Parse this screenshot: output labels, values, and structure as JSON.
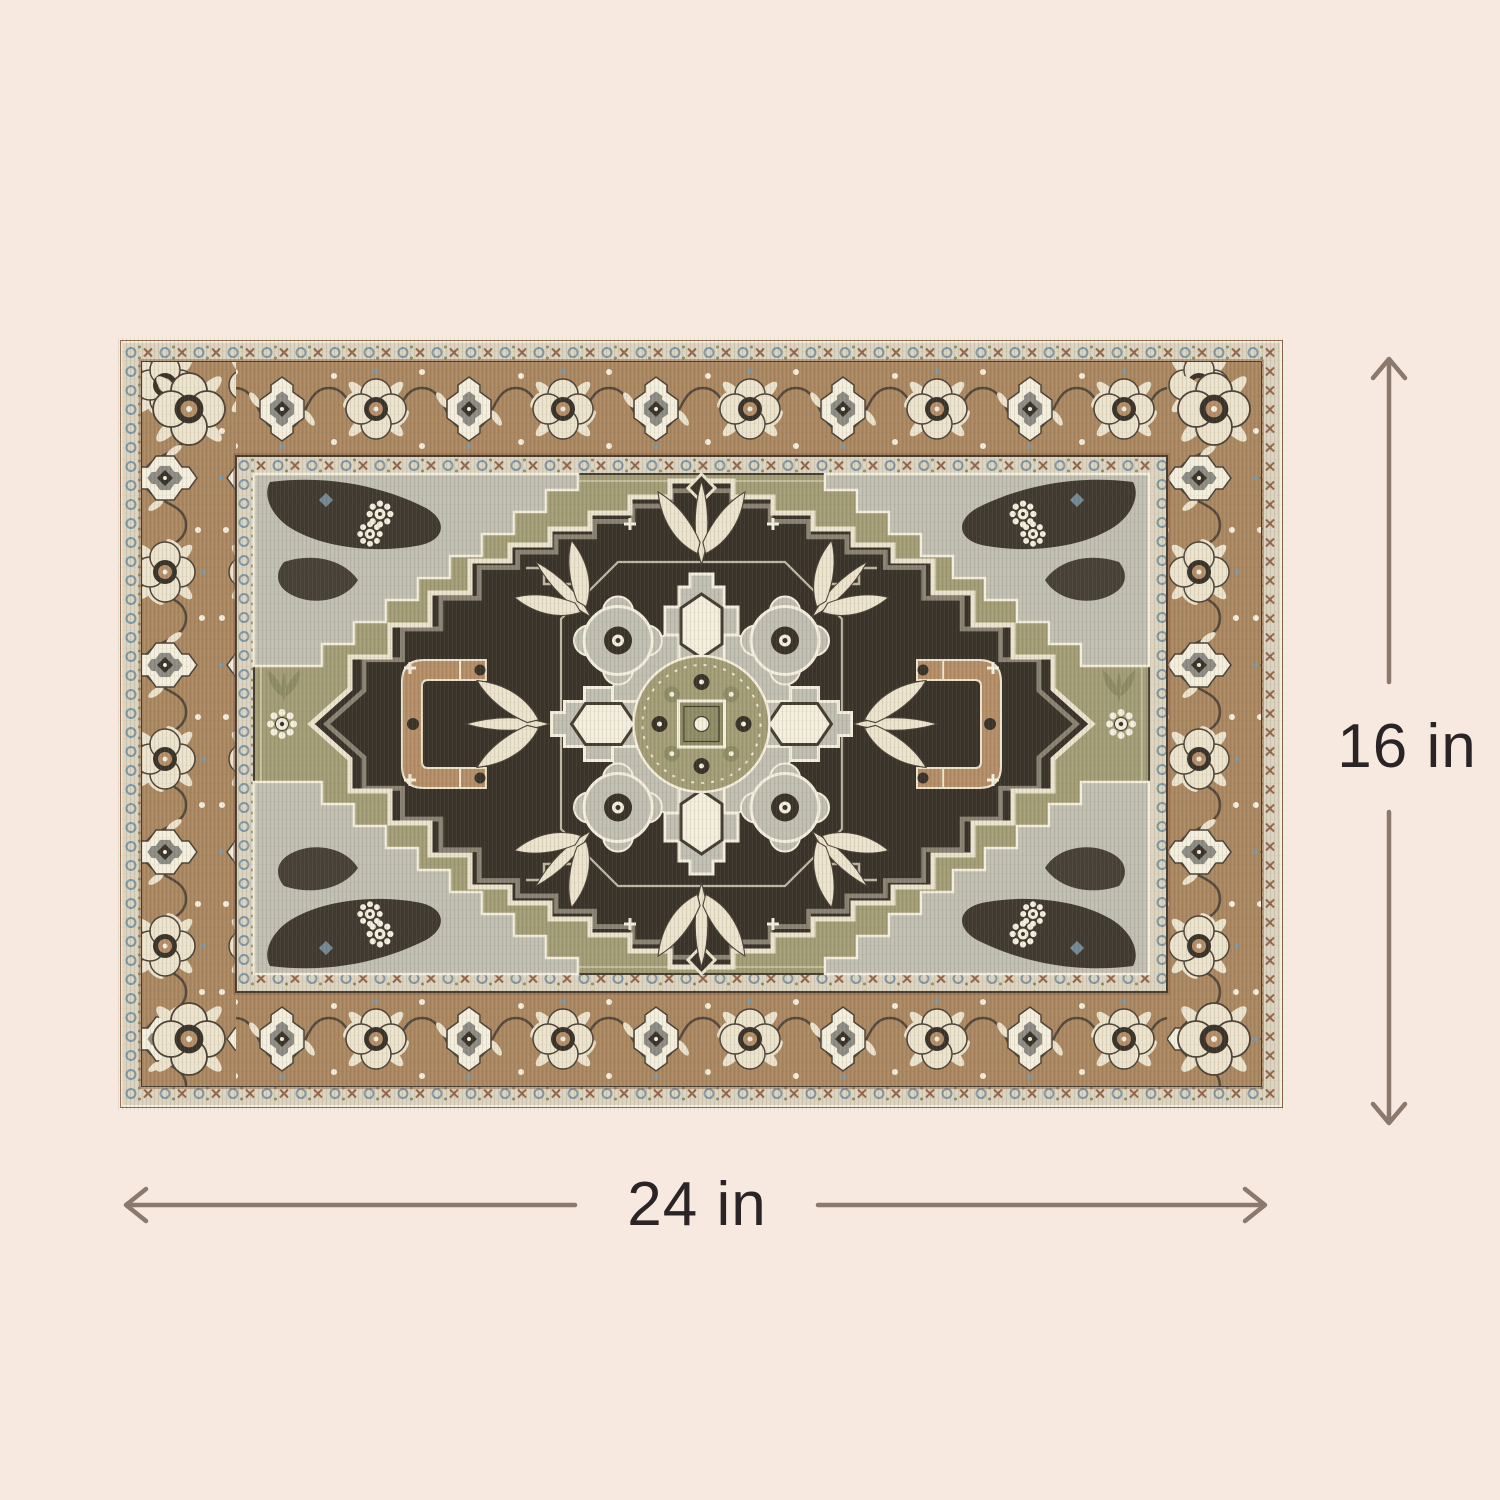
{
  "image": {
    "description": "Product dimension illustration of an ornate oriental medallion area rug on a plain cream background",
    "background_color": "#f8e9e0"
  },
  "dimensions": {
    "width": {
      "label": "24 in"
    },
    "height": {
      "label": "16 in"
    }
  },
  "annotation": {
    "arrow_color": "#8a796c",
    "label_color": "#2b2426"
  },
  "rug": {
    "style": "heriz-medallion-rug",
    "palette": {
      "brown": "#ab8861",
      "cream": "#ece3cd",
      "cream2": "#f4eede",
      "charcoal": "#3a332a",
      "olive": "#a49e76",
      "olive2": "#8f8d66",
      "gray": "#c1bfb2",
      "gray2": "#8d8c85",
      "guard": "#dcd4c0",
      "blue": "#7d98a7",
      "rust": "#96664a",
      "tan": "#b58e68",
      "dark": "#463d33",
      "vine": "#4c4237"
    }
  }
}
